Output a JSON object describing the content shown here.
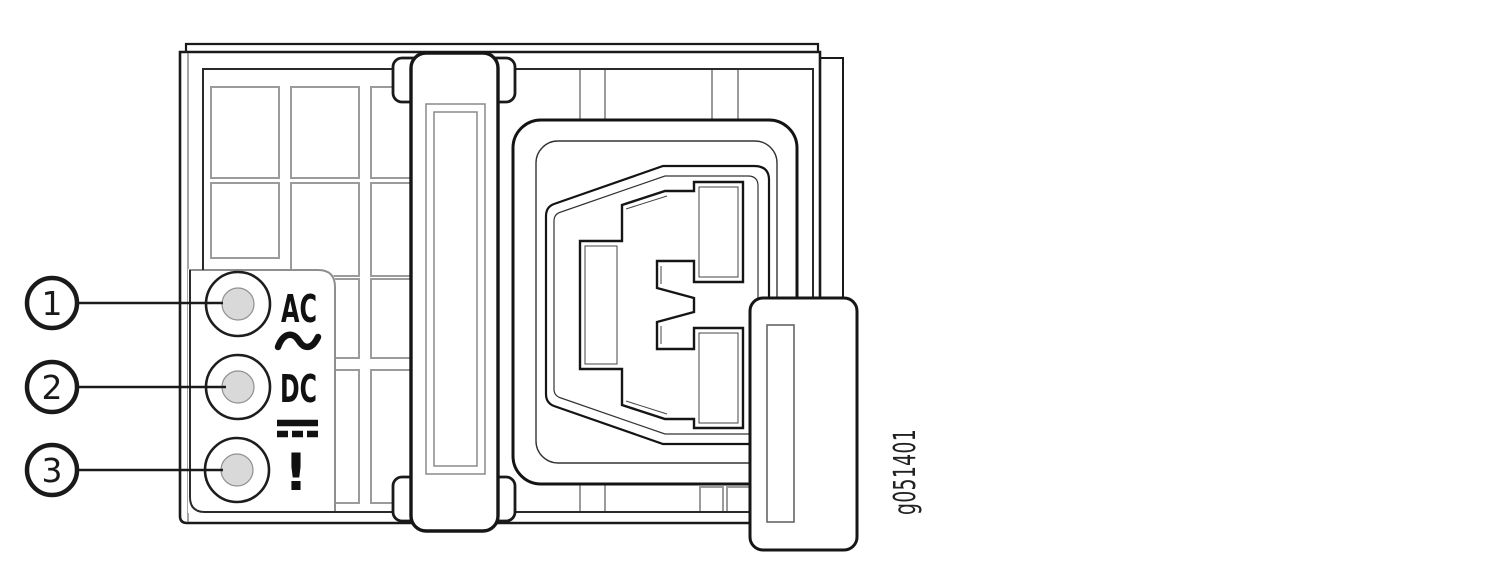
{
  "figure": {
    "id_label": "g051401",
    "title": "Power supply status LEDs diagram",
    "callouts": [
      {
        "number": "1"
      },
      {
        "number": "2"
      },
      {
        "number": "3"
      }
    ],
    "leds": {
      "ac_label": "AC",
      "dc_label": "DC",
      "alarm_label": "!"
    },
    "icons": {
      "ac_waveform": "ac-tilde-icon",
      "dc_symbol": "dc-bars-icon"
    },
    "colors": {
      "line": "#1a1a1a",
      "grid_line": "#9b9b9b",
      "led_fill": "#d9d9d9"
    }
  }
}
